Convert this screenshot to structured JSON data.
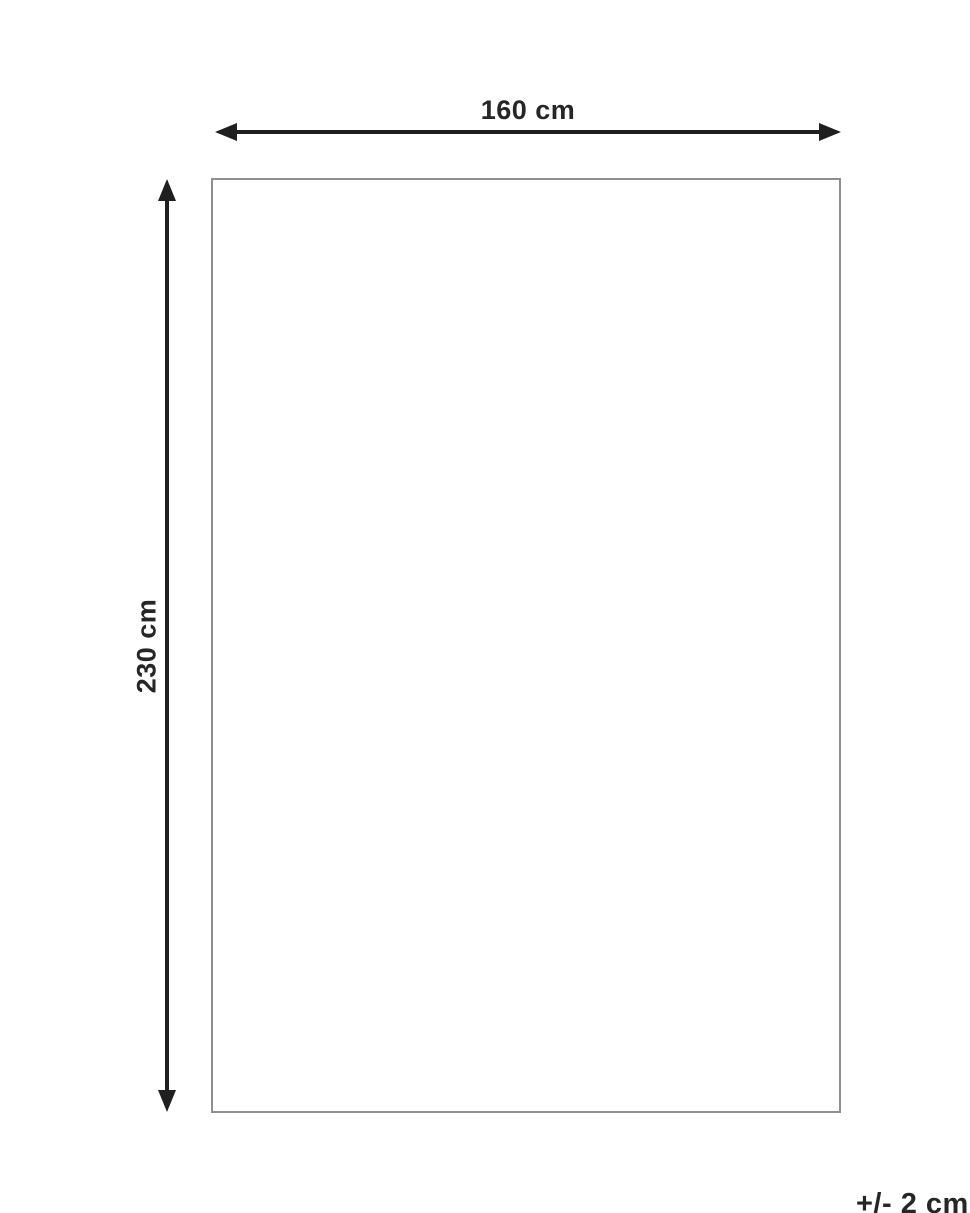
{
  "diagram": {
    "width_label": "160 cm",
    "height_label": "230 cm",
    "tolerance_label": "+/- 2 cm",
    "colors": {
      "arrow": "#1f1f1f",
      "text": "#262626",
      "rect_border": "#8f8f8f",
      "background": "#ffffff"
    }
  }
}
